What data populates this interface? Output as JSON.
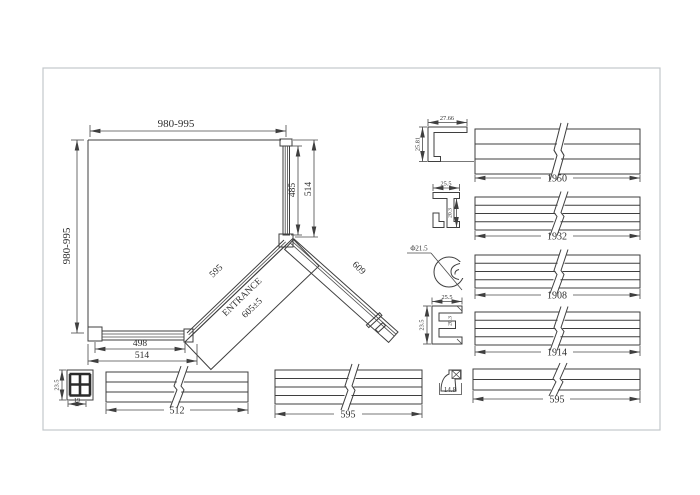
{
  "plan": {
    "width_top": "980-995",
    "height_left": "980-995",
    "side_panel_glass": "485",
    "side_panel_total": "514",
    "fixed_diagonal": "595",
    "entrance": "ENTRANCE",
    "entrance_width": "605±5",
    "door_panel": "609",
    "bottom_glass": "498",
    "bottom_total": "514"
  },
  "profiles": {
    "wall_channel": {
      "width": "27.66",
      "height": "25.81"
    },
    "glass_channel": {
      "width": "25.5",
      "depth": "20.3"
    },
    "round_tube": {
      "diameter": "Φ21.5"
    },
    "frame_extrusion": {
      "width": "25.5",
      "height": "23.5",
      "depth": "20.3"
    },
    "seal_bracket": {
      "width": "14.8"
    },
    "corner_block": {
      "height": "23.5",
      "width": "19"
    }
  },
  "bars": [
    {
      "name": "rail-1950",
      "length": "1950"
    },
    {
      "name": "rail-1932",
      "length": "1932"
    },
    {
      "name": "rail-1908",
      "length": "1908"
    },
    {
      "name": "rail-1914",
      "length": "1914"
    },
    {
      "name": "rail-595-right",
      "length": "595"
    },
    {
      "name": "rail-512",
      "length": "512"
    },
    {
      "name": "rail-595-bottom",
      "length": "595"
    }
  ],
  "colors": {
    "line": "#3f3f3f",
    "text": "#2e2e2e",
    "border": "#c3c7cb",
    "background": "#ffffff"
  }
}
